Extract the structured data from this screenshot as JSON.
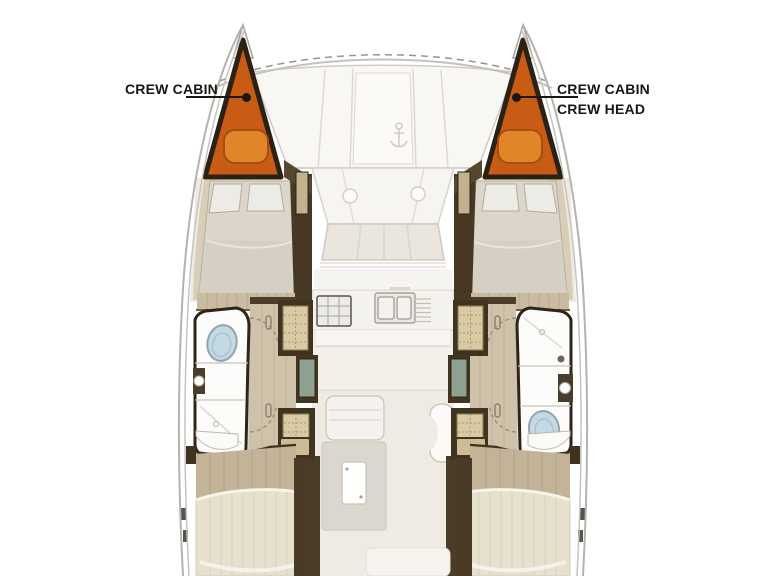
{
  "callouts": {
    "port": {
      "line1": "CREW CABIN"
    },
    "starboard": {
      "line1": "CREW CABIN",
      "line2": "CREW HEAD"
    }
  },
  "colors": {
    "crew_cabin_fill": "#c85c15",
    "crew_cabin_berth": "#e08629",
    "hull_outline": "#2b2214",
    "wood_floor": "#cfc2ab",
    "toilet_blue": "#c3d9e4",
    "shower_green": "#8fa291",
    "label_text": "#1a1613",
    "background": "#ffffff"
  }
}
